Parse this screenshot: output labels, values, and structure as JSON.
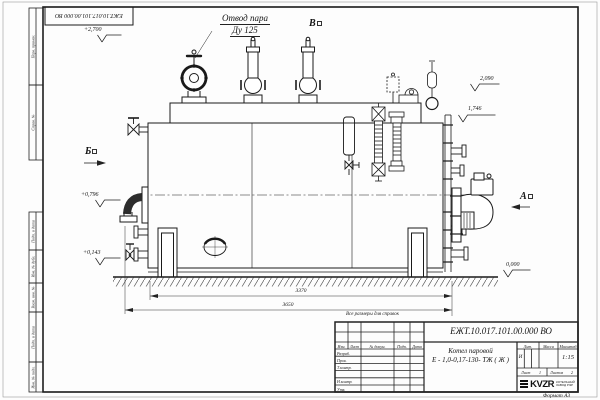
{
  "frame": {
    "top_stamp": "ЕЖТ.10.017.101.00.000  ВО",
    "format_note": "Формат А3",
    "margin_labels": [
      "Перв. примен.",
      "Справ. №",
      "Подп. и дата",
      "Инв. № дубл.",
      "Взам. инв. №",
      "Подп. и дата",
      "Инв. № подл."
    ]
  },
  "drawing": {
    "callout": {
      "line1": "Отвод пара",
      "line2": "Ду 125"
    },
    "view_markers": {
      "a": "А",
      "b": "Б",
      "v": "В"
    },
    "elevations": {
      "e2700": "+2,700",
      "e2090": "2,090",
      "e1746": "1,746",
      "e0796": "+0,796",
      "e0143": "+0,143",
      "e0000": "0,000"
    },
    "dimensions": {
      "d3370": "3370",
      "d3650": "3650"
    },
    "note": "Все размеры для справок"
  },
  "title_block": {
    "doc_number": "ЕЖТ.10.017.101.00.000  ВО",
    "product_name_line1": "Котел паровой",
    "product_name_line2": "Е - 1,0-0,17-130- ТЖ ( Ж )",
    "header": {
      "izm": "Изм.",
      "list": "Лист",
      "doc": "№ докум.",
      "podp": "Подп.",
      "data": "Дата"
    },
    "rows": [
      "Разраб.",
      "Пров.",
      "Т.контр.",
      "Н.контр.",
      "Утв."
    ],
    "lit_header": "Лит.",
    "massa_header": "Масса",
    "scale_header": "Масштаб",
    "lit_value": "И",
    "scale_value": "1:15",
    "sheet_label": "Лист",
    "sheet_value": "1",
    "sheets_label": "Листов",
    "sheets_value": "2",
    "logo_text": "KVZR",
    "org_line1": "КОТЕЛЬНЫЙ",
    "org_line2": "ЗАВОД РЭР"
  }
}
